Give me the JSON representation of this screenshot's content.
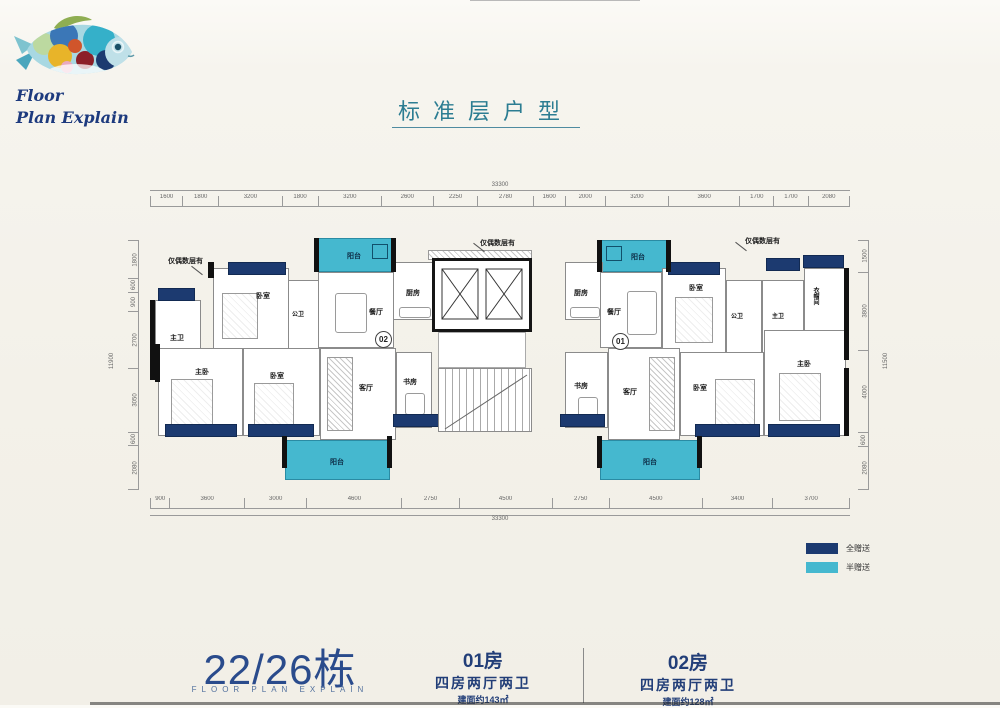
{
  "logo": {
    "line1": "Floor",
    "line2": "Plan Explain"
  },
  "title": "标准层户型",
  "plan": {
    "even_floor_note": "仅偶数层有",
    "unit01_circle": "01",
    "unit02_circle": "02",
    "rooms": {
      "balcony": "阳台",
      "kitchen": "厨房",
      "dining": "餐厅",
      "bedroom": "卧室",
      "public_bath": "公卫",
      "master_bath": "主卫",
      "master_bed": "主卧",
      "living": "客厅",
      "study": "书房",
      "cloakroom": "衣帽间"
    },
    "dims": {
      "total_h": "33300",
      "total_v_left": "11900",
      "total_v_right": "11500",
      "top": [
        "1600",
        "1800",
        "3200",
        "1800",
        "3200",
        "2600",
        "2250",
        "2780",
        "1600",
        "2000",
        "3200",
        "3600",
        "1700",
        "1700",
        "2080"
      ],
      "bottom": [
        "900",
        "3600",
        "3000",
        "4600",
        "2750",
        "4500",
        "2750",
        "4500",
        "3400",
        "3700"
      ],
      "left": [
        "1800",
        "600",
        "900",
        "2700",
        "3050",
        "600",
        "2080"
      ],
      "right": [
        "1500",
        "3800",
        "4000",
        "600",
        "2080"
      ]
    }
  },
  "legend": {
    "full_gift": "全赠送",
    "half_gift": "半赠送",
    "navy_color": "#1c3a70",
    "cyan_color": "#45b8cf"
  },
  "footer": {
    "building": "22/26栋",
    "building_sub": "FLOOR PLAN EXPLAIN",
    "unit01": {
      "name": "01房",
      "layout": "四房两厅两卫",
      "area": "建面约143㎡"
    },
    "unit02": {
      "name": "02房",
      "layout": "四房两厅两卫",
      "area": "建面约128㎡"
    }
  }
}
